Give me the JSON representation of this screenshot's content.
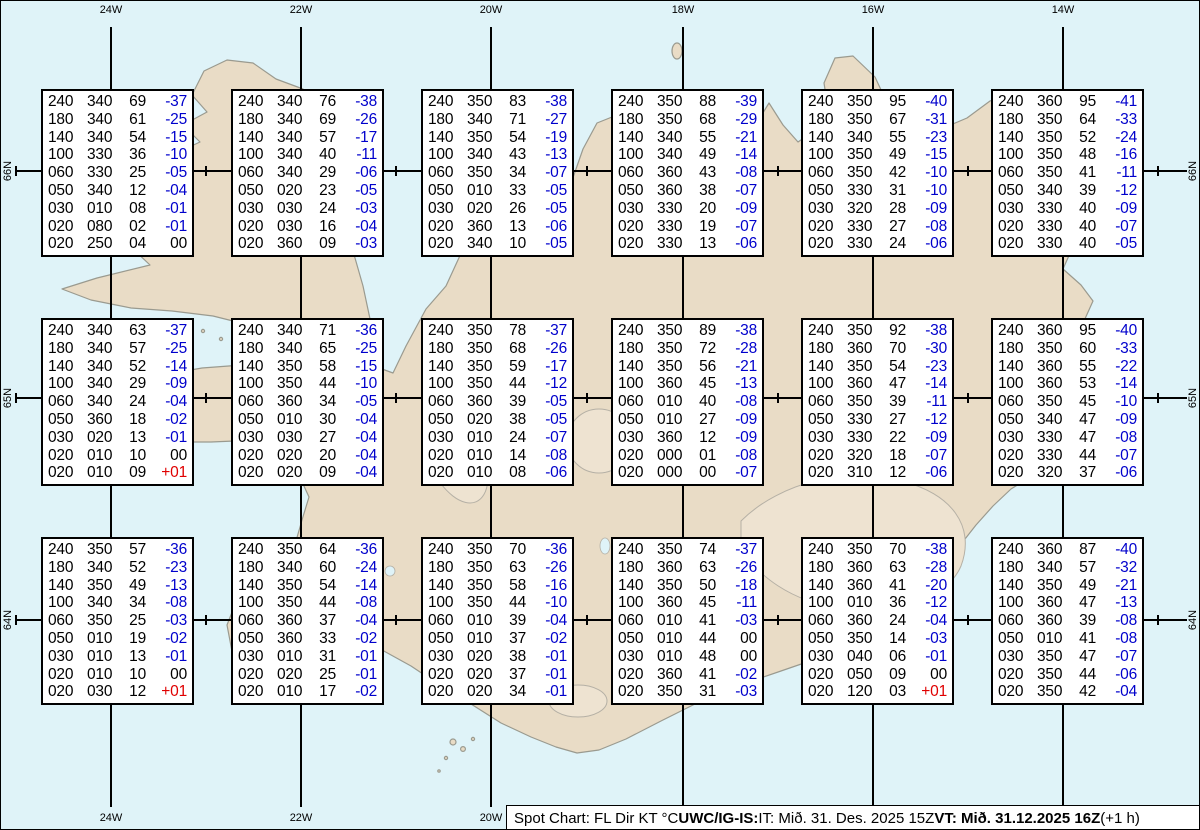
{
  "map": {
    "region": "Iceland",
    "top_longitude_labels": [
      "24W",
      "22W",
      "20W",
      "18W",
      "16W",
      "14W"
    ],
    "bottom_longitude_labels": [
      "24W",
      "22W",
      "20W",
      "18W",
      "16W",
      "14W"
    ],
    "left_latitude_labels": [
      "66N",
      "65N",
      "64N"
    ],
    "right_latitude_labels": [
      "66N",
      "65N",
      "64N"
    ]
  },
  "colors": {
    "water": "#dff3f8",
    "land": "#e9dcc6",
    "coastline": "#9a9a8f",
    "temp_negative": "#0000cc",
    "temp_positive": "#e00000",
    "value_text": "#000000"
  },
  "footer": {
    "prefix": "Spot Chart: FL Dir KT °C ",
    "source_bold": "UWC/IG-IS:",
    "issue_time": " IT: Mið. 31. Des. 2025 15Z ",
    "valid_bold": "VT: Mið. 31.12.2025 16Z",
    "suffix": " (+1 h)"
  },
  "chart_data": {
    "type": "table",
    "title": "Spot Chart: FL Dir KT °C",
    "columns": [
      "FL",
      "Dir",
      "KT",
      "°C"
    ],
    "grid": {
      "rows": 3,
      "cols": 6
    },
    "stations": [
      {
        "row": 0,
        "col": 0,
        "rows": [
          [
            "240",
            "340",
            "69",
            "-37"
          ],
          [
            "180",
            "340",
            "61",
            "-25"
          ],
          [
            "140",
            "340",
            "54",
            "-15"
          ],
          [
            "100",
            "330",
            "36",
            "-10"
          ],
          [
            "060",
            "330",
            "25",
            "-05"
          ],
          [
            "050",
            "340",
            "12",
            "-04"
          ],
          [
            "030",
            "010",
            "08",
            "-01"
          ],
          [
            "020",
            "080",
            "02",
            "-01"
          ],
          [
            "020",
            "250",
            "04",
            "00"
          ]
        ]
      },
      {
        "row": 0,
        "col": 1,
        "rows": [
          [
            "240",
            "340",
            "76",
            "-38"
          ],
          [
            "180",
            "340",
            "69",
            "-26"
          ],
          [
            "140",
            "340",
            "57",
            "-17"
          ],
          [
            "100",
            "340",
            "40",
            "-11"
          ],
          [
            "060",
            "340",
            "29",
            "-06"
          ],
          [
            "050",
            "020",
            "23",
            "-05"
          ],
          [
            "030",
            "030",
            "24",
            "-03"
          ],
          [
            "020",
            "030",
            "16",
            "-04"
          ],
          [
            "020",
            "360",
            "09",
            "-03"
          ]
        ]
      },
      {
        "row": 0,
        "col": 2,
        "rows": [
          [
            "240",
            "350",
            "83",
            "-38"
          ],
          [
            "180",
            "340",
            "71",
            "-27"
          ],
          [
            "140",
            "350",
            "54",
            "-19"
          ],
          [
            "100",
            "340",
            "43",
            "-13"
          ],
          [
            "060",
            "350",
            "34",
            "-07"
          ],
          [
            "050",
            "010",
            "33",
            "-05"
          ],
          [
            "030",
            "020",
            "26",
            "-05"
          ],
          [
            "020",
            "360",
            "13",
            "-06"
          ],
          [
            "020",
            "340",
            "10",
            "-05"
          ]
        ]
      },
      {
        "row": 0,
        "col": 3,
        "rows": [
          [
            "240",
            "350",
            "88",
            "-39"
          ],
          [
            "180",
            "350",
            "68",
            "-29"
          ],
          [
            "140",
            "340",
            "55",
            "-21"
          ],
          [
            "100",
            "340",
            "49",
            "-14"
          ],
          [
            "060",
            "360",
            "43",
            "-08"
          ],
          [
            "050",
            "360",
            "38",
            "-07"
          ],
          [
            "030",
            "330",
            "20",
            "-09"
          ],
          [
            "020",
            "330",
            "19",
            "-07"
          ],
          [
            "020",
            "330",
            "13",
            "-06"
          ]
        ]
      },
      {
        "row": 0,
        "col": 4,
        "rows": [
          [
            "240",
            "350",
            "95",
            "-40"
          ],
          [
            "180",
            "350",
            "67",
            "-31"
          ],
          [
            "140",
            "340",
            "55",
            "-23"
          ],
          [
            "100",
            "350",
            "49",
            "-15"
          ],
          [
            "060",
            "350",
            "42",
            "-10"
          ],
          [
            "050",
            "330",
            "31",
            "-10"
          ],
          [
            "030",
            "320",
            "28",
            "-09"
          ],
          [
            "020",
            "330",
            "27",
            "-08"
          ],
          [
            "020",
            "330",
            "24",
            "-06"
          ]
        ]
      },
      {
        "row": 0,
        "col": 5,
        "rows": [
          [
            "240",
            "360",
            "95",
            "-41"
          ],
          [
            "180",
            "350",
            "64",
            "-33"
          ],
          [
            "140",
            "350",
            "52",
            "-24"
          ],
          [
            "100",
            "350",
            "48",
            "-16"
          ],
          [
            "060",
            "350",
            "41",
            "-11"
          ],
          [
            "050",
            "340",
            "39",
            "-12"
          ],
          [
            "030",
            "330",
            "40",
            "-09"
          ],
          [
            "020",
            "330",
            "40",
            "-07"
          ],
          [
            "020",
            "330",
            "40",
            "-05"
          ]
        ]
      },
      {
        "row": 1,
        "col": 0,
        "rows": [
          [
            "240",
            "340",
            "63",
            "-37"
          ],
          [
            "180",
            "340",
            "57",
            "-25"
          ],
          [
            "140",
            "340",
            "52",
            "-14"
          ],
          [
            "100",
            "340",
            "29",
            "-09"
          ],
          [
            "060",
            "340",
            "24",
            "-04"
          ],
          [
            "050",
            "360",
            "18",
            "-02"
          ],
          [
            "030",
            "020",
            "13",
            "-01"
          ],
          [
            "020",
            "010",
            "10",
            "00"
          ],
          [
            "020",
            "010",
            "09",
            "+01"
          ]
        ]
      },
      {
        "row": 1,
        "col": 1,
        "rows": [
          [
            "240",
            "340",
            "71",
            "-36"
          ],
          [
            "180",
            "340",
            "65",
            "-25"
          ],
          [
            "140",
            "350",
            "58",
            "-15"
          ],
          [
            "100",
            "350",
            "44",
            "-10"
          ],
          [
            "060",
            "360",
            "34",
            "-05"
          ],
          [
            "050",
            "010",
            "30",
            "-04"
          ],
          [
            "030",
            "030",
            "27",
            "-04"
          ],
          [
            "020",
            "020",
            "20",
            "-04"
          ],
          [
            "020",
            "020",
            "09",
            "-04"
          ]
        ]
      },
      {
        "row": 1,
        "col": 2,
        "rows": [
          [
            "240",
            "350",
            "78",
            "-37"
          ],
          [
            "180",
            "350",
            "68",
            "-26"
          ],
          [
            "140",
            "350",
            "59",
            "-17"
          ],
          [
            "100",
            "350",
            "44",
            "-12"
          ],
          [
            "060",
            "360",
            "39",
            "-05"
          ],
          [
            "050",
            "020",
            "38",
            "-05"
          ],
          [
            "030",
            "010",
            "24",
            "-07"
          ],
          [
            "020",
            "010",
            "14",
            "-08"
          ],
          [
            "020",
            "010",
            "08",
            "-06"
          ]
        ]
      },
      {
        "row": 1,
        "col": 3,
        "rows": [
          [
            "240",
            "350",
            "89",
            "-38"
          ],
          [
            "180",
            "350",
            "72",
            "-28"
          ],
          [
            "140",
            "350",
            "56",
            "-21"
          ],
          [
            "100",
            "360",
            "45",
            "-13"
          ],
          [
            "060",
            "010",
            "40",
            "-08"
          ],
          [
            "050",
            "010",
            "27",
            "-09"
          ],
          [
            "030",
            "360",
            "12",
            "-09"
          ],
          [
            "020",
            "000",
            "01",
            "-08"
          ],
          [
            "020",
            "000",
            "00",
            "-07"
          ]
        ]
      },
      {
        "row": 1,
        "col": 4,
        "rows": [
          [
            "240",
            "350",
            "92",
            "-38"
          ],
          [
            "180",
            "360",
            "70",
            "-30"
          ],
          [
            "140",
            "350",
            "54",
            "-23"
          ],
          [
            "100",
            "360",
            "47",
            "-14"
          ],
          [
            "060",
            "350",
            "39",
            "-11"
          ],
          [
            "050",
            "330",
            "27",
            "-12"
          ],
          [
            "030",
            "330",
            "22",
            "-09"
          ],
          [
            "020",
            "320",
            "18",
            "-07"
          ],
          [
            "020",
            "310",
            "12",
            "-06"
          ]
        ]
      },
      {
        "row": 1,
        "col": 5,
        "rows": [
          [
            "240",
            "360",
            "95",
            "-40"
          ],
          [
            "180",
            "350",
            "60",
            "-33"
          ],
          [
            "140",
            "360",
            "55",
            "-22"
          ],
          [
            "100",
            "360",
            "53",
            "-14"
          ],
          [
            "060",
            "350",
            "45",
            "-10"
          ],
          [
            "050",
            "340",
            "47",
            "-09"
          ],
          [
            "030",
            "330",
            "47",
            "-08"
          ],
          [
            "020",
            "330",
            "44",
            "-07"
          ],
          [
            "020",
            "320",
            "37",
            "-06"
          ]
        ]
      },
      {
        "row": 2,
        "col": 0,
        "rows": [
          [
            "240",
            "350",
            "57",
            "-36"
          ],
          [
            "180",
            "340",
            "52",
            "-23"
          ],
          [
            "140",
            "350",
            "49",
            "-13"
          ],
          [
            "100",
            "340",
            "34",
            "-08"
          ],
          [
            "060",
            "350",
            "25",
            "-03"
          ],
          [
            "050",
            "010",
            "19",
            "-02"
          ],
          [
            "030",
            "010",
            "13",
            "-01"
          ],
          [
            "020",
            "010",
            "10",
            "00"
          ],
          [
            "020",
            "030",
            "12",
            "+01"
          ]
        ]
      },
      {
        "row": 2,
        "col": 1,
        "rows": [
          [
            "240",
            "350",
            "64",
            "-36"
          ],
          [
            "180",
            "340",
            "60",
            "-24"
          ],
          [
            "140",
            "350",
            "54",
            "-14"
          ],
          [
            "100",
            "350",
            "44",
            "-08"
          ],
          [
            "060",
            "360",
            "37",
            "-04"
          ],
          [
            "050",
            "360",
            "33",
            "-02"
          ],
          [
            "030",
            "010",
            "31",
            "-01"
          ],
          [
            "020",
            "020",
            "25",
            "-01"
          ],
          [
            "020",
            "010",
            "17",
            "-02"
          ]
        ]
      },
      {
        "row": 2,
        "col": 2,
        "rows": [
          [
            "240",
            "350",
            "70",
            "-36"
          ],
          [
            "180",
            "350",
            "63",
            "-26"
          ],
          [
            "140",
            "350",
            "58",
            "-16"
          ],
          [
            "100",
            "350",
            "44",
            "-10"
          ],
          [
            "060",
            "010",
            "39",
            "-04"
          ],
          [
            "050",
            "010",
            "37",
            "-02"
          ],
          [
            "030",
            "020",
            "38",
            "-01"
          ],
          [
            "020",
            "020",
            "37",
            "-01"
          ],
          [
            "020",
            "020",
            "34",
            "-01"
          ]
        ]
      },
      {
        "row": 2,
        "col": 3,
        "rows": [
          [
            "240",
            "350",
            "74",
            "-37"
          ],
          [
            "180",
            "360",
            "63",
            "-26"
          ],
          [
            "140",
            "350",
            "50",
            "-18"
          ],
          [
            "100",
            "360",
            "45",
            "-11"
          ],
          [
            "060",
            "010",
            "41",
            "-03"
          ],
          [
            "050",
            "010",
            "44",
            "00"
          ],
          [
            "030",
            "010",
            "48",
            "00"
          ],
          [
            "020",
            "360",
            "41",
            "-02"
          ],
          [
            "020",
            "350",
            "31",
            "-03"
          ]
        ]
      },
      {
        "row": 2,
        "col": 4,
        "rows": [
          [
            "240",
            "350",
            "70",
            "-38"
          ],
          [
            "180",
            "360",
            "63",
            "-28"
          ],
          [
            "140",
            "360",
            "41",
            "-20"
          ],
          [
            "100",
            "010",
            "36",
            "-12"
          ],
          [
            "060",
            "360",
            "24",
            "-04"
          ],
          [
            "050",
            "350",
            "14",
            "-03"
          ],
          [
            "030",
            "040",
            "06",
            "-01"
          ],
          [
            "020",
            "050",
            "09",
            "00"
          ],
          [
            "020",
            "120",
            "03",
            "+01"
          ]
        ]
      },
      {
        "row": 2,
        "col": 5,
        "rows": [
          [
            "240",
            "360",
            "87",
            "-40"
          ],
          [
            "180",
            "340",
            "57",
            "-32"
          ],
          [
            "140",
            "350",
            "49",
            "-21"
          ],
          [
            "100",
            "360",
            "47",
            "-13"
          ],
          [
            "060",
            "360",
            "39",
            "-08"
          ],
          [
            "050",
            "010",
            "41",
            "-08"
          ],
          [
            "030",
            "350",
            "47",
            "-07"
          ],
          [
            "020",
            "350",
            "44",
            "-06"
          ],
          [
            "020",
            "350",
            "42",
            "-04"
          ]
        ]
      }
    ]
  }
}
